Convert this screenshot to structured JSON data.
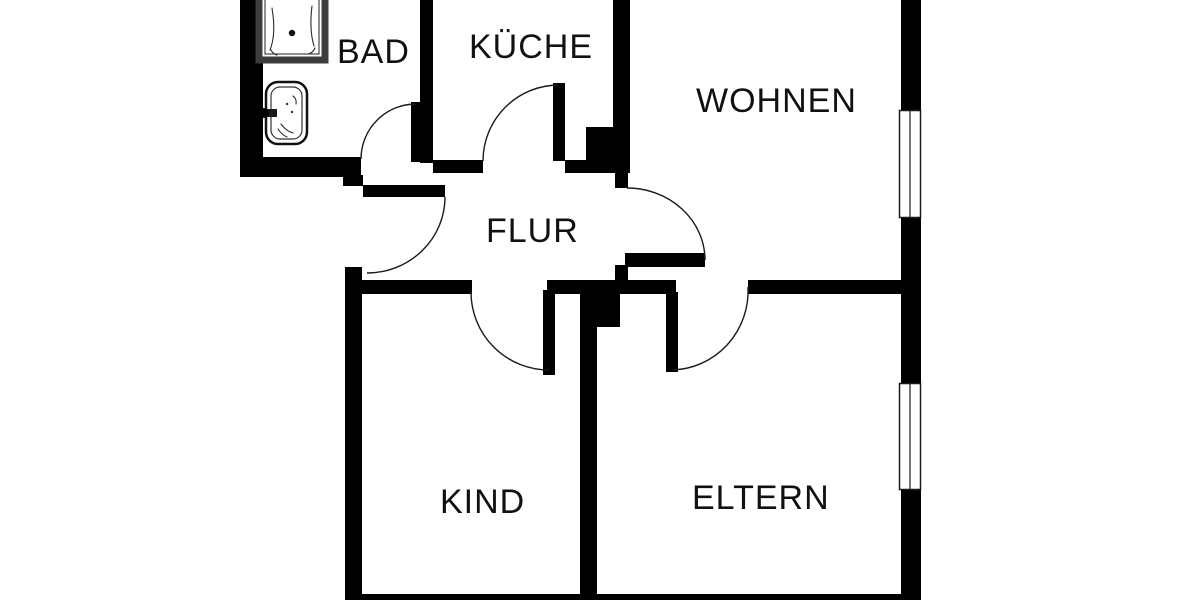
{
  "rooms": [
    {
      "id": "bad",
      "label": "BAD"
    },
    {
      "id": "kueche",
      "label": "KÜCHE"
    },
    {
      "id": "wohnen",
      "label": "WOHNEN"
    },
    {
      "id": "flur",
      "label": "FLUR"
    },
    {
      "id": "kind",
      "label": "KIND"
    },
    {
      "id": "eltern",
      "label": "ELTERN"
    }
  ],
  "fixtures": [
    {
      "icon": "bathtub-icon"
    },
    {
      "icon": "sink-icon"
    }
  ],
  "colors": {
    "wall": "#000000",
    "line": "#1a1a1a",
    "label": "#111111",
    "background": "#ffffff",
    "tub_border": "#3d3d3d"
  }
}
